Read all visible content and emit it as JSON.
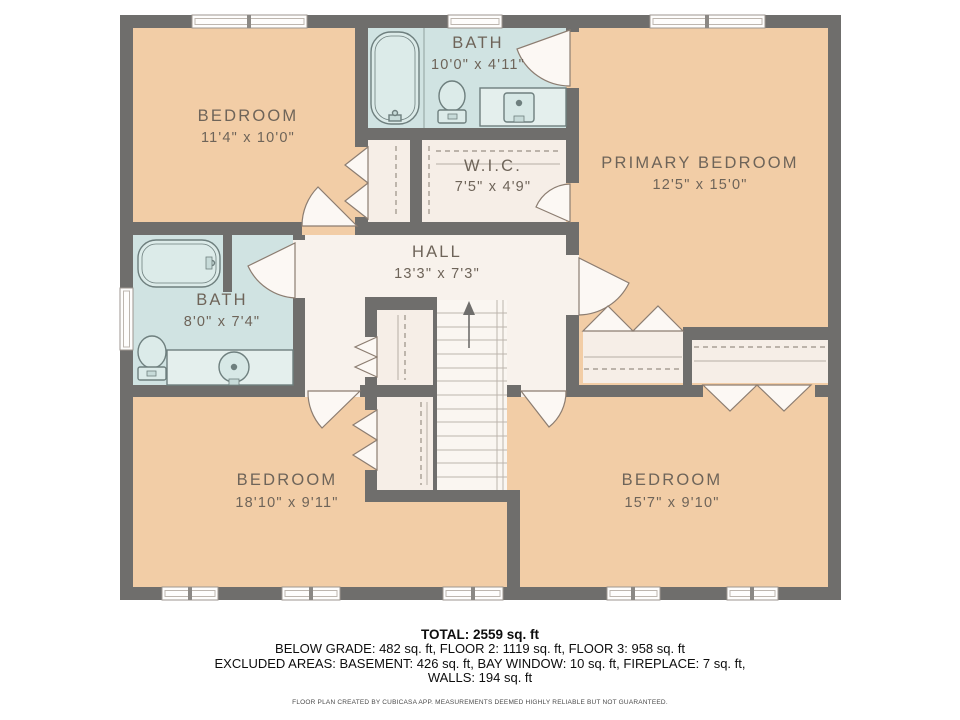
{
  "plan": {
    "rooms": [
      {
        "name": "BEDROOM",
        "dims": "11'4\" x 10'0\""
      },
      {
        "name": "BATH",
        "dims": "10'0\" x 4'11\""
      },
      {
        "name": "W.I.C.",
        "dims": "7'5\" x 4'9\""
      },
      {
        "name": "PRIMARY BEDROOM",
        "dims": "12'5\" x 15'0\""
      },
      {
        "name": "HALL",
        "dims": "13'3\" x 7'3\""
      },
      {
        "name": "BATH",
        "dims": "8'0\" x 7'4\""
      },
      {
        "name": "BEDROOM",
        "dims": "18'10\" x 9'11\""
      },
      {
        "name": "BEDROOM",
        "dims": "15'7\" x 9'10\""
      }
    ],
    "colors": {
      "wall": "#6f6e6c",
      "room_fill": "#f2cda6",
      "bath_fill": "#d0e3e2",
      "closet_fill": "#f6eee7",
      "hall_fill": "#f8f2ec",
      "label": "#6e6459"
    }
  },
  "summary": {
    "total": "TOTAL: 2559 sq. ft",
    "line1": "BELOW GRADE: 482 sq. ft, FLOOR 2: 1119 sq. ft, FLOOR 3: 958 sq. ft",
    "line2": "EXCLUDED AREAS: BASEMENT: 426 sq. ft, BAY WINDOW: 10 sq. ft, FIREPLACE: 7 sq. ft,",
    "line3": "WALLS: 194 sq. ft"
  },
  "footer": "FLOOR PLAN CREATED BY CUBICASA APP. MEASUREMENTS DEEMED HIGHLY RELIABLE BUT NOT GUARANTEED."
}
